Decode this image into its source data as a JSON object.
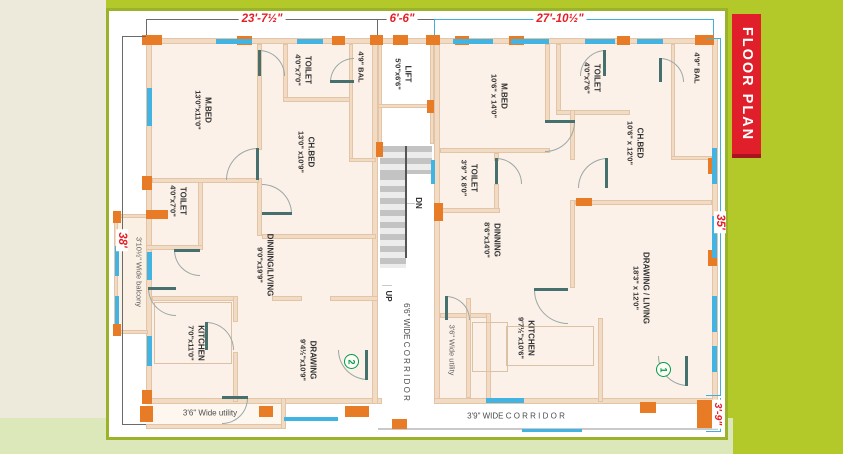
{
  "ribbon": {
    "text": "FLOOR PLAN"
  },
  "dims": {
    "top_left": "23'-7½\"",
    "top_mid": "6'-6\"",
    "top_right": "27'-10½\"",
    "left": "38'",
    "right": "35'",
    "bottom_right": "3'-9\""
  },
  "core": {
    "lift_name": "LIFT",
    "lift_dims": "5'0\"x6'6\"",
    "dn": "DN",
    "up": "UP",
    "corridor_v": "6'6\" WIDE C O R R I D O R",
    "corridor_h": "3'9\" WIDE C O R R I D O R"
  },
  "unit2": {
    "badge": "2",
    "mbed": {
      "name": "M.BED",
      "dims": "13'0\"x11'0\""
    },
    "toilet_top": {
      "name": "TOILET",
      "dims": "4'0\"x7'0\""
    },
    "bal": "4'9\" BAL",
    "chbed": {
      "name": "CH.BED",
      "dims": "13'0\" x10'9\""
    },
    "toilet_left": {
      "name": "TOILET",
      "dims": "4'0\"x7'0\""
    },
    "balcony": "3'10½\" Wide balcony",
    "dinliv": {
      "name": "DINNING/LIVING",
      "dims": "9'0\"x19'9\""
    },
    "kitchen": {
      "name": "KITCHEN",
      "dims": "7'0\"x11'0\""
    },
    "drawing": {
      "name": "DRAWING",
      "dims": "9'4½\"x10'9\""
    },
    "utility": "3'6\" Wide utility"
  },
  "unit1": {
    "badge": "1",
    "mbed": {
      "name": "M.BED",
      "dims": "10'6\" x 14'0\""
    },
    "toilet_top": {
      "name": "TOILET",
      "dims": "4'0\"x7'6\""
    },
    "bal": "4'9\" BAL",
    "chbed": {
      "name": "CH.BED",
      "dims": "10'6\" x 12'0\""
    },
    "toilet_side": {
      "name": "TOILET",
      "dims": "3'9\" X 8'0\""
    },
    "dinning": {
      "name": "DINNING",
      "dims": "8'6\"x14'0\""
    },
    "kitchen": {
      "name": "KITCHEN",
      "dims": "9'7½\"x10'6\""
    },
    "drawliv": {
      "name": "DRAWING / LIVING",
      "dims": "18'3\" x 12'0\""
    },
    "utility": "3'6\" Wide utility"
  }
}
